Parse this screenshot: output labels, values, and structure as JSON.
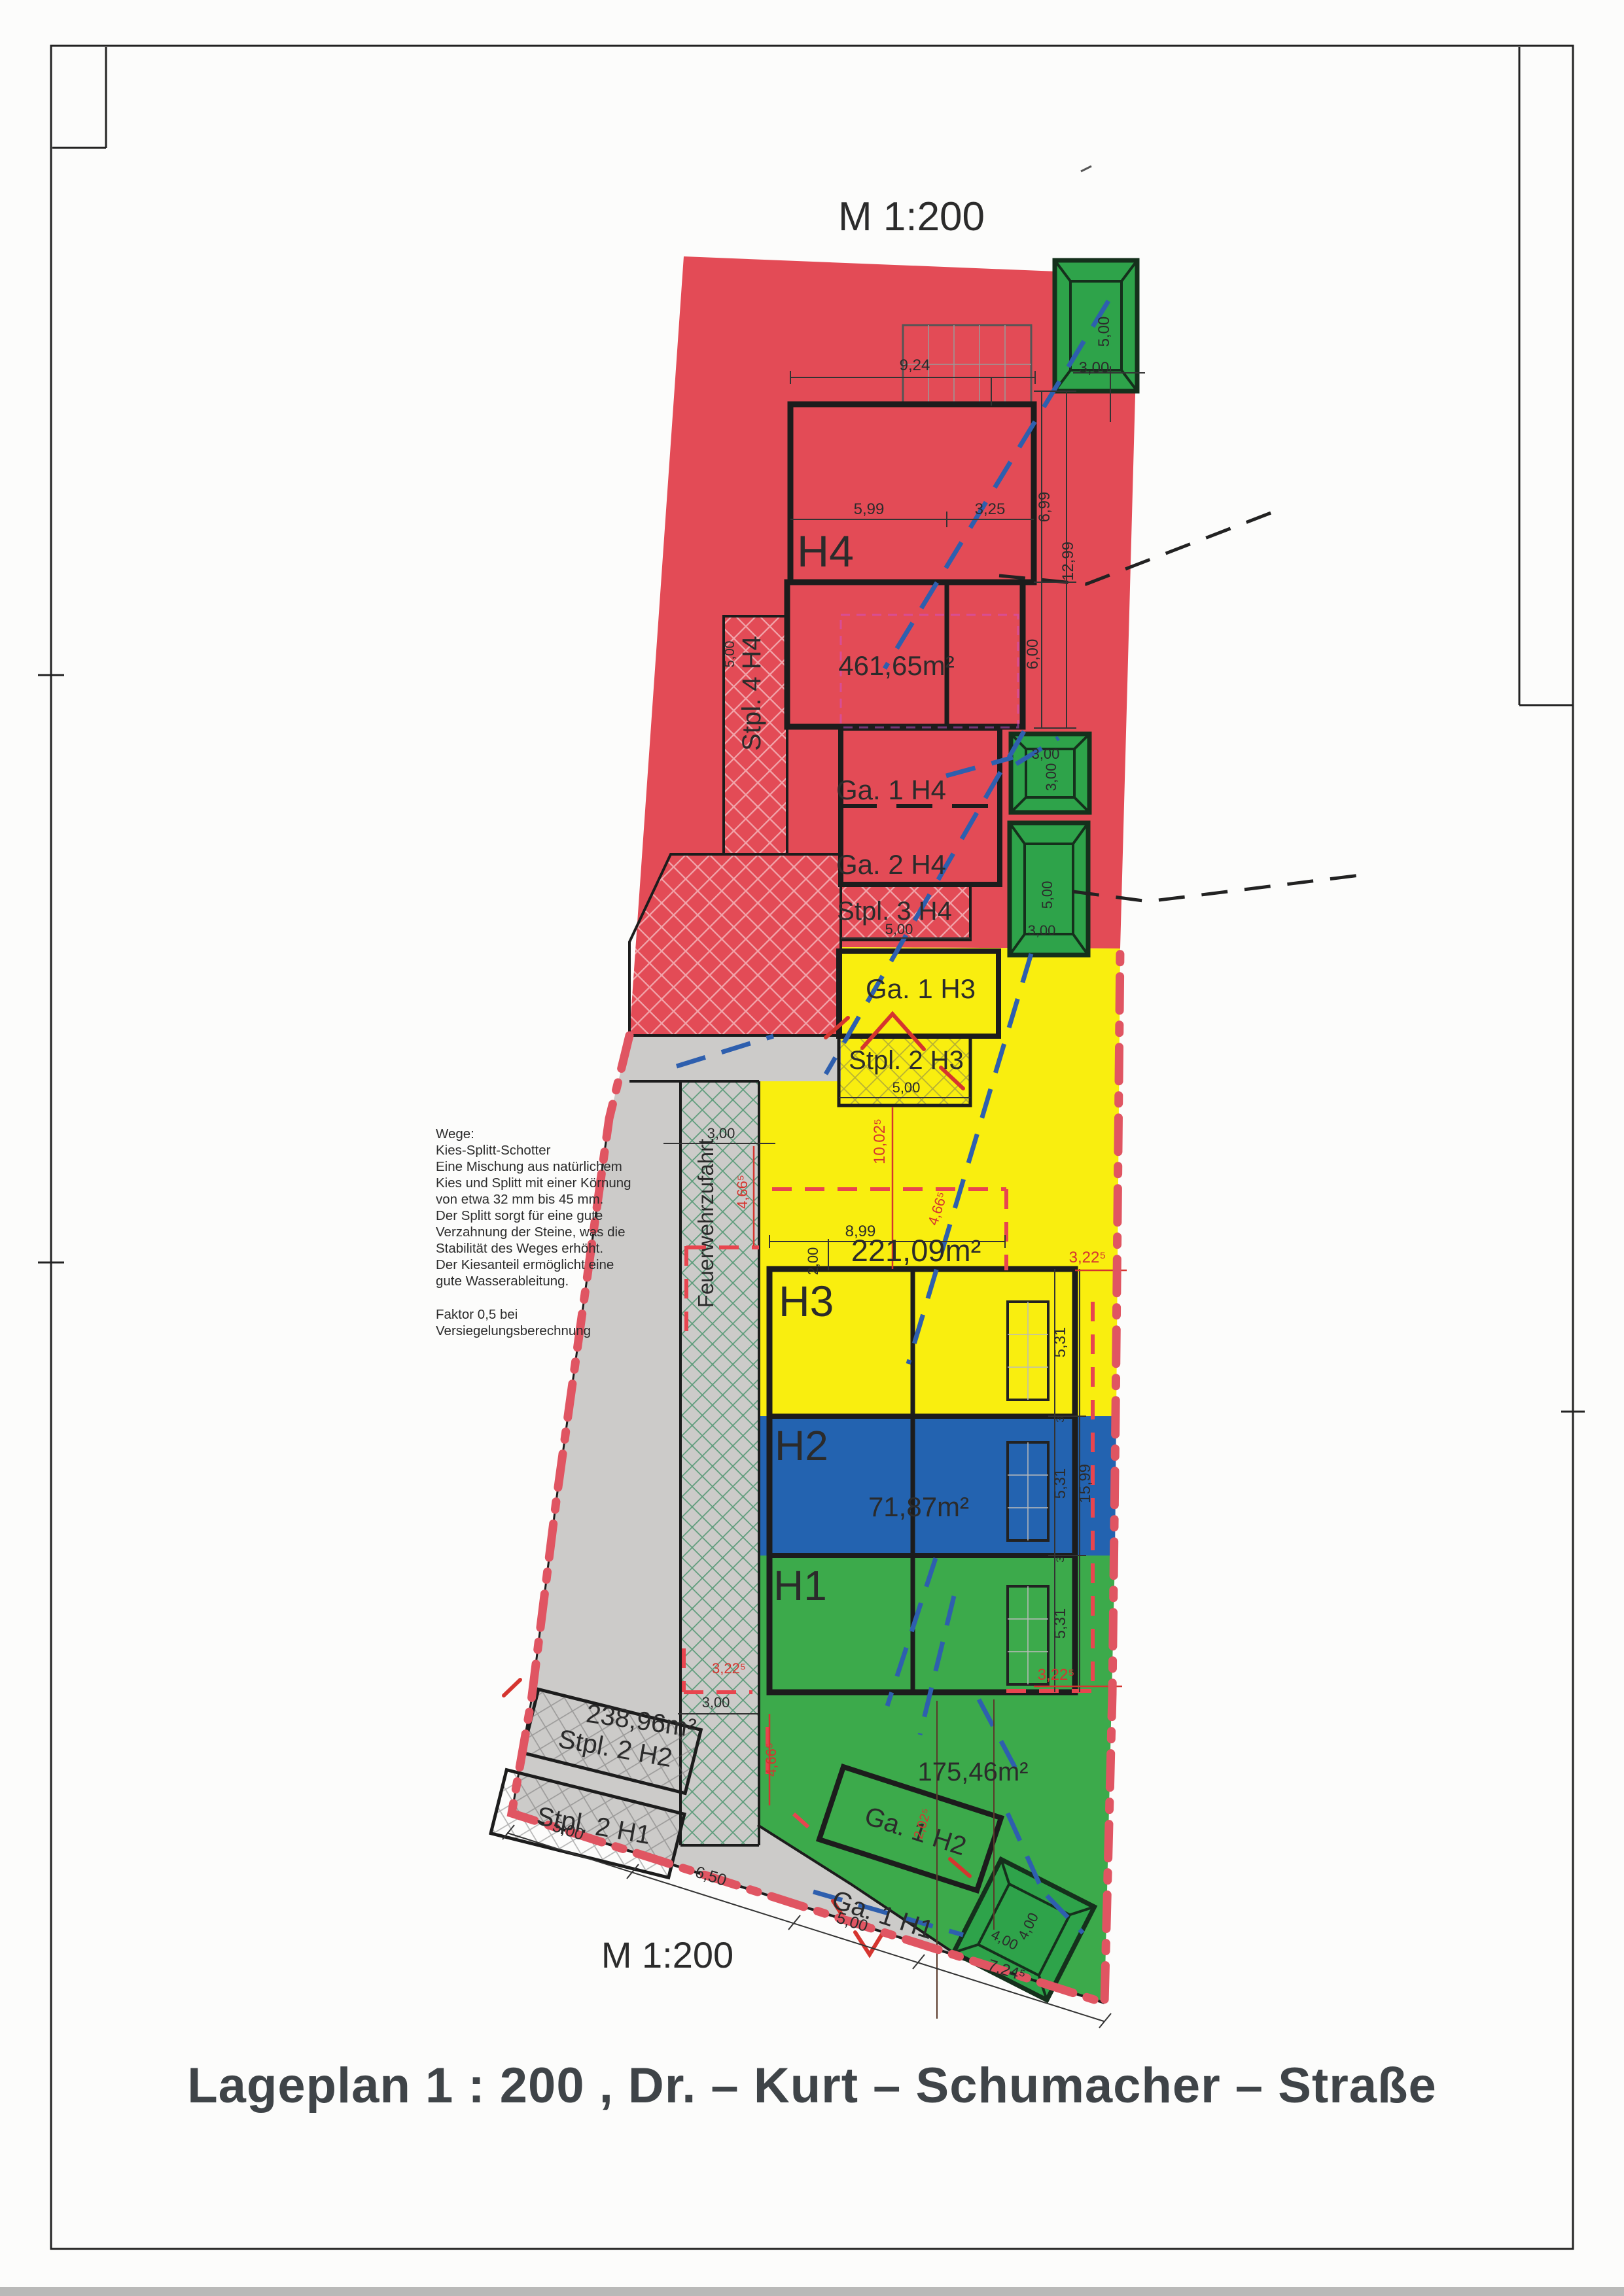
{
  "page": {
    "scale_top": "M 1:200",
    "scale_bottom": "M 1:200",
    "title": "Lageplan 1 : 200 , Dr. – Kurt – Schumacher – Straße"
  },
  "notes": {
    "lines": [
      "Wege:",
      "Kies-Splitt-Schotter",
      "Eine Mischung aus natürlichem",
      "Kies und Splitt mit einer Körnung",
      "von etwa 32 mm bis 45 mm.",
      "Der Splitt sorgt für eine gute",
      "Verzahnung der Steine, was die",
      "Stabilität des Weges erhöht.",
      "Der Kiesanteil ermöglicht eine",
      "gute Wasserableitung."
    ],
    "factor_lines": [
      "Faktor  0,5 bei",
      "Versiegelungsberechnung"
    ]
  },
  "buildings": {
    "h4": "H4",
    "h3": "H3",
    "h2": "H2",
    "h1": "H1"
  },
  "areas": {
    "h4": "461,65m²",
    "h3": "221,09m²",
    "h2": "71,87m²",
    "garden": "175,46m²",
    "stpl": "238,96m²"
  },
  "units": {
    "ga1h4": "Ga. 1 H4",
    "ga2h4": "Ga. 2 H4",
    "stpl3h4": "Stpl. 3 H4",
    "stpl4h4": "Stpl. 4 H4",
    "ga1h3": "Ga. 1 H3",
    "stpl2h3": "Stpl. 2 H3",
    "stpl2h2": "Stpl. 2 H2",
    "stpl2h1": "Stpl. 2 H1",
    "ga1h2": "Ga. 1 H2",
    "ga1h1": "Ga. 1 H1",
    "feuerwehr": "Feuerwehrzufahrt"
  },
  "dims": {
    "d924": "9,24",
    "d599": "5,99",
    "d325": "3,25",
    "d300": "3,00",
    "d500": "5,00",
    "d400": "4,00",
    "d699": "6,99",
    "d1299": "12,99",
    "d600": "6,00",
    "d899": "8,99",
    "d200": "2,00",
    "d1002": "10,02⁵",
    "d466": "4,66⁵",
    "d322": "3,22⁵",
    "d531": "5,31",
    "d1599": "15,99",
    "d650": "6,50",
    "d724": "7,24⁵",
    "d202": "2,02⁵",
    "d3": "3"
  },
  "colors": {
    "red": "#e34b56",
    "yellow": "#f9ee0f",
    "blue": "#2363b0",
    "green": "#3caa4b",
    "tree": "#2ea34a",
    "gray": "#cccbc9",
    "boundary": "#e05562"
  }
}
